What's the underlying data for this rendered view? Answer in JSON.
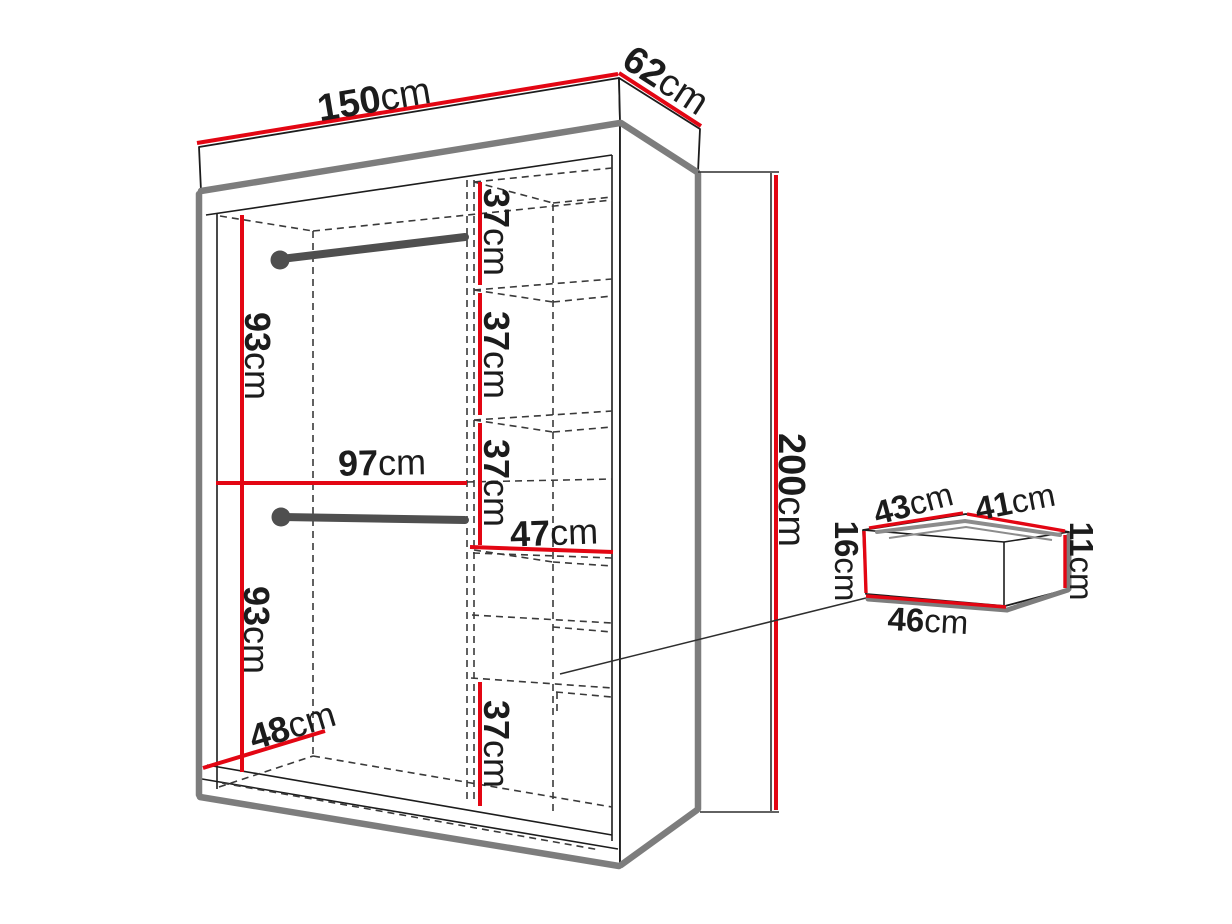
{
  "diagram": {
    "kind": "wardrobe-dimension-diagram",
    "unit": "cm"
  },
  "colors": {
    "dimension_red": "#e30613",
    "outline_black": "#1c1c1c",
    "panel_gray": "#7d7d7d",
    "rim_gray": "#8c8c8c",
    "rod_gray": "#4f4f4f",
    "dash_gray": "#3a3a3a",
    "background": "#ffffff"
  },
  "wardrobe": {
    "top_width": {
      "num": "150",
      "unit": "cm"
    },
    "top_depth": {
      "num": "62",
      "unit": "cm"
    },
    "height": {
      "num": "200",
      "unit": "cm"
    },
    "upper_hanging_height": {
      "num": "93",
      "unit": "cm"
    },
    "hanging_width": {
      "num": "97",
      "unit": "cm"
    },
    "lower_hanging_height": {
      "num": "93",
      "unit": "cm"
    },
    "floor_depth": {
      "num": "48",
      "unit": "cm"
    },
    "shelf_gap_1": {
      "num": "37",
      "unit": "cm"
    },
    "shelf_gap_2": {
      "num": "37",
      "unit": "cm"
    },
    "shelf_gap_3": {
      "num": "37",
      "unit": "cm"
    },
    "shelf_column_width": {
      "num": "47",
      "unit": "cm"
    },
    "shelf_gap_4": {
      "num": "37",
      "unit": "cm"
    }
  },
  "drawer": {
    "top_depth": {
      "num": "43",
      "unit": "cm"
    },
    "top_width": {
      "num": "41",
      "unit": "cm"
    },
    "front_height": {
      "num": "16",
      "unit": "cm"
    },
    "back_height": {
      "num": "11",
      "unit": "cm"
    },
    "bottom_width": {
      "num": "46",
      "unit": "cm"
    }
  }
}
